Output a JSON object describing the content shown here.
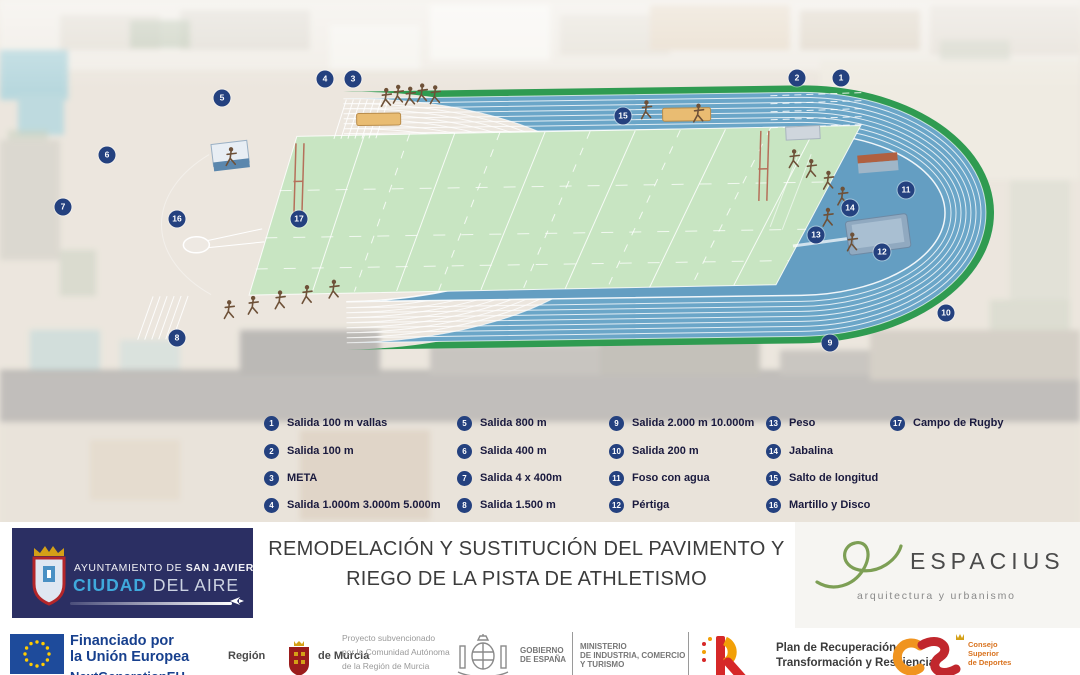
{
  "stations": [
    {
      "num": "1",
      "label": "Salida 100 m vallas"
    },
    {
      "num": "2",
      "label": "Salida 100 m"
    },
    {
      "num": "3",
      "label": "META"
    },
    {
      "num": "4",
      "label": "Salida 1.000m 3.000m 5.000m"
    },
    {
      "num": "5",
      "label": "Salida 800 m"
    },
    {
      "num": "6",
      "label": "Salida 400 m"
    },
    {
      "num": "7",
      "label": "Salida 4 x 400m"
    },
    {
      "num": "8",
      "label": "Salida 1.500 m"
    },
    {
      "num": "9",
      "label": "Salida 2.000 m 10.000m"
    },
    {
      "num": "10",
      "label": "Salida 200 m"
    },
    {
      "num": "11",
      "label": "Foso con agua"
    },
    {
      "num": "12",
      "label": "Pértiga"
    },
    {
      "num": "13",
      "label": "Peso"
    },
    {
      "num": "14",
      "label": "Jabalina"
    },
    {
      "num": "15",
      "label": "Salto de longitud"
    },
    {
      "num": "16",
      "label": "Martillo y Disco"
    },
    {
      "num": "17",
      "label": "Campo de Rugby"
    }
  ],
  "banner": {
    "ayuntamiento": {
      "pre": "AYUNTAMIENTO DE ",
      "bold": "SAN JAVIER",
      "city": "CIUDAD",
      "rest": " DEL AIRE"
    },
    "title_line1": "REMODELACIÓN Y SUSTITUCIÓN DEL PAVIMENTO Y",
    "title_line2": "RIEGO DE LA PISTA DE ATHLETISMO",
    "espacius": {
      "name": "ESPACIUS",
      "tagline": "arquitectura y urbanismo"
    }
  },
  "funding": {
    "eu": {
      "line1": "Financiado por",
      "line2": "la Unión Europea",
      "line3": "NextGenerationEU"
    },
    "murcia": {
      "region": "Región",
      "de": "de Murcia",
      "sub1": "Proyecto subvencionado",
      "sub2": "por la Comunidad Autónoma",
      "sub3": "de la Región de Murcia"
    },
    "gobierno": {
      "g1": "GOBIERNO",
      "g2": "DE ESPAÑA",
      "m1": "MINISTERIO",
      "m2": "DE INDUSTRIA, COMERCIO",
      "m3": "Y TURISMO"
    },
    "prtr": {
      "line1": "Plan de Recuperación,",
      "line2": "Transformación y Resiliencia"
    },
    "csd": {
      "line1": "Consejo",
      "line2": "Superior",
      "line3": "de Deportes"
    }
  },
  "colors": {
    "track_blue": "#6ba6c8",
    "infield_blue": "#649ec2",
    "edge_green": "#2f9b51",
    "rugby_green": "#c8e5c2",
    "marker_navy": "#24417f",
    "eu_blue": "#1e4b9b",
    "eu_star": "#ffcc00",
    "espacius_green": "#7d9f55"
  }
}
